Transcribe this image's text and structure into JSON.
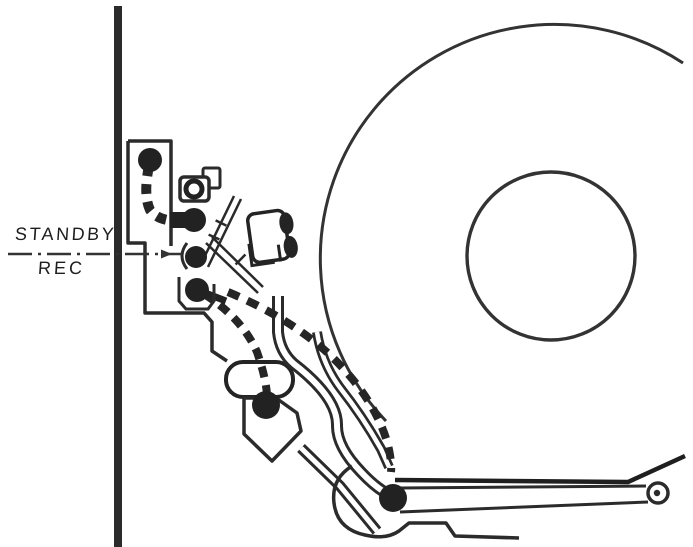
{
  "diagram": {
    "title": "tape-transport-mechanism-side-view",
    "labels": {
      "standby": "STANDBY",
      "rec": "REC"
    },
    "colors": {
      "ink": "#2b2b2b",
      "paper": "#ffffff",
      "divider_line": "#333333"
    },
    "components": [
      "chassis-wall",
      "chassis-plate",
      "lamp-bracket",
      "entry-guide-roller",
      "guide-roller-upper",
      "guide-roller-mid",
      "guide-roller-lower",
      "rec-head-block",
      "scissor-levers",
      "pinch-roller-capsule",
      "pinch-roller",
      "lever-plate-hexagon",
      "head-drum",
      "drum-hub",
      "linkage-band-head",
      "linkage-band-drum-edge",
      "linkage-band-lower",
      "pivot-roller",
      "tension-arm",
      "arm-end-guide-ring",
      "tape-path-entry",
      "tape-path-standby",
      "tape-path-rec",
      "mode-divider-line"
    ]
  }
}
